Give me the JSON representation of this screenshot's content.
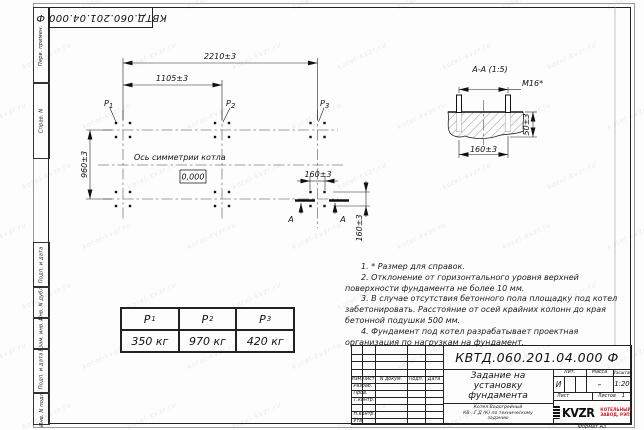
{
  "page": {
    "format_label": "Формат А3",
    "watermark": "kotel-kvzr.ru"
  },
  "top_stamp": {
    "doc_number": "КВТД.060.201.04.000 Ф"
  },
  "side_strip": {
    "cells": [
      {
        "label": "Перв. примен."
      },
      {
        "label": "Справ. N"
      },
      {
        "label": "Подп. и дата"
      },
      {
        "label": "Инв. N дубл."
      },
      {
        "label": "Взам. инв. N"
      },
      {
        "label": "Подп. и дата"
      },
      {
        "label": "Инв. N подл."
      }
    ]
  },
  "plan": {
    "dim_2210": "2210±3",
    "dim_1105": "1105±3",
    "dim_960": "960±3",
    "dim_160_h": "160±3",
    "dim_160_v": "160±3",
    "axis_label": "Ось симметрии котла",
    "elevation": "0,000",
    "load_p": "P",
    "load_subs": {
      "p1": "1",
      "p2": "2",
      "p3": "3"
    },
    "section_letter": "А"
  },
  "section_view": {
    "title": "А-А (1:5)",
    "thread_label": "М16*",
    "dim_160": "160±3",
    "dim_50": "50±3"
  },
  "loads_table": {
    "headers": [
      {
        "p": "P",
        "sub": "1"
      },
      {
        "p": "P",
        "sub": "2"
      },
      {
        "p": "P",
        "sub": "3"
      }
    ],
    "values": [
      "350 кг",
      "970 кг",
      "420 кг"
    ]
  },
  "notes": {
    "items": [
      "1. * Размер для справок.",
      "2. Отклонение от горизонтального уровня верхней поверхности фундамента не более 10 мм.",
      "3. В случае отсутствия бетонного пола площадку под котел забетонировать. Расстояние от осей крайних колонн до края бетонной подушки 500 мм.",
      "4. Фундамент под котел разрабатывает проектная организация по нагрузкам на фундамент."
    ]
  },
  "title_block": {
    "doc_number": "КВТД.060.201.04.000 Ф",
    "title_lines": [
      "Задание на",
      "установку",
      "фундамента"
    ],
    "subtitle_lines": [
      "Котел Водогрейный",
      "КВ-..Г,Д (К) по техническому",
      "заданию"
    ],
    "header_cols": [
      "Изм.",
      "Лист",
      "N докум.",
      "Подп.",
      "Дата"
    ],
    "sig_rows": [
      "Разраб.",
      "Пров.",
      "Т.контр.",
      "Н.контр.",
      "Утв."
    ],
    "lit_label": "Лит.",
    "lit_value": "И",
    "mass_label": "Масса",
    "mass_value": "–",
    "scale_label": "Масштаб",
    "scale_value": "1:20",
    "sheet_label": "Лист",
    "sheets_label": "Листов",
    "sheets_value": "1",
    "company_logo": "KVZR",
    "company_name_lines": [
      "КОТЕЛЬНЫЙ",
      "ЗАВОД, РЭП"
    ],
    "company_color": "#c42222"
  }
}
